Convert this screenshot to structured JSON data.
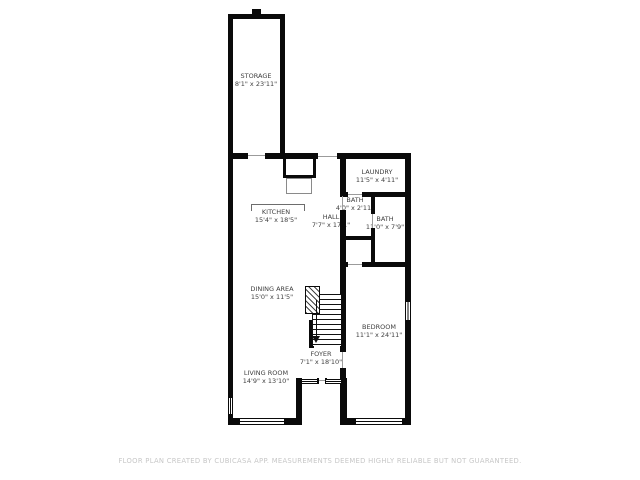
{
  "app": {
    "type": "floor-plan"
  },
  "rooms": [
    {
      "name": "STORAGE",
      "dims": "8'1\" x 23'11\""
    },
    {
      "name": "LAUNDRY",
      "dims": "11'5\" x 4'11\""
    },
    {
      "name": "BATH",
      "dims": "4'0\" x 2'11\""
    },
    {
      "name": "BATH",
      "dims": "11'0\" x 7'9\""
    },
    {
      "name": "KITCHEN",
      "dims": "15'4\" x 18'5\""
    },
    {
      "name": "HALL",
      "dims": "7'7\" x 17'1\""
    },
    {
      "name": "DINING AREA",
      "dims": "15'0\" x 11'5\""
    },
    {
      "name": "BEDROOM",
      "dims": "11'1\" x 24'11\""
    },
    {
      "name": "FOYER",
      "dims": "7'1\" x 18'10\""
    },
    {
      "name": "LIVING ROOM",
      "dims": "14'9\" x 13'10\""
    }
  ],
  "footer": "FLOOR PLAN CREATED BY CUBICASA APP. MEASUREMENTS DEEMED HIGHLY RELIABLE BUT NOT GUARANTEED.",
  "colors": {
    "wall": "#0a0a0a",
    "label_text": "#3f3f3f",
    "footer_text": "#c7c7c7",
    "background": "#ffffff"
  }
}
